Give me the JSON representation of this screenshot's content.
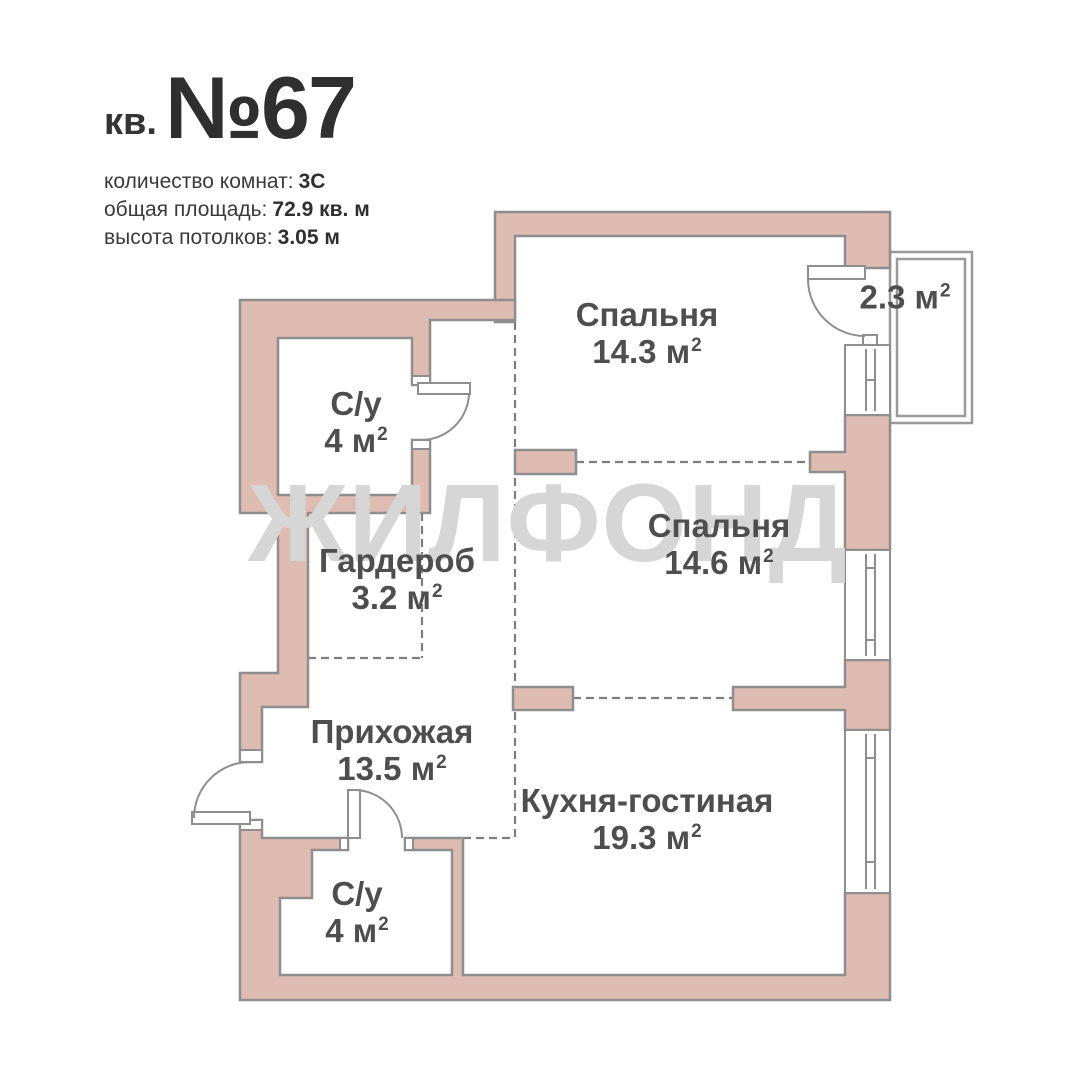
{
  "header": {
    "unit_prefix": "кв.",
    "unit_number": "№67",
    "info": [
      {
        "label": "количество комнат:",
        "value": "3С"
      },
      {
        "label": "общая площадь:",
        "value": "72.9 кв. м"
      },
      {
        "label": "высота потолков:",
        "value": "3.05 м"
      }
    ]
  },
  "watermark": "ЖИЛФОНД",
  "rooms": [
    {
      "id": "bedroom-1",
      "name": "Спальня",
      "area": "14.3 м",
      "sup": "2"
    },
    {
      "id": "balcony",
      "name": "",
      "area": "2.3 м",
      "sup": "2"
    },
    {
      "id": "bathroom-top",
      "name": "С/у",
      "area": "4 м",
      "sup": "2"
    },
    {
      "id": "bedroom-2",
      "name": "Спальня",
      "area": "14.6 м",
      "sup": "2"
    },
    {
      "id": "wardrobe",
      "name": "Гардероб",
      "area": "3.2 м",
      "sup": "2"
    },
    {
      "id": "hallway",
      "name": "Прихожая",
      "area": "13.5 м",
      "sup": "2"
    },
    {
      "id": "kitchen-living",
      "name": "Кухня-гостиная",
      "area": "19.3 м",
      "sup": "2"
    },
    {
      "id": "bathroom-bottom",
      "name": "С/у",
      "area": "4 м",
      "sup": "2"
    }
  ],
  "colors": {
    "wall_fill": "#DFBCB2",
    "wall_stroke": "#8E8E8E",
    "dashed_line": "#7E7E7E",
    "balcony_outline": "#9A9A9A",
    "room_label_text": "#4E4E4E",
    "header_text": "#3A3A3A",
    "watermark_text": "#D6D6D6",
    "background": "#FFFFFF"
  }
}
